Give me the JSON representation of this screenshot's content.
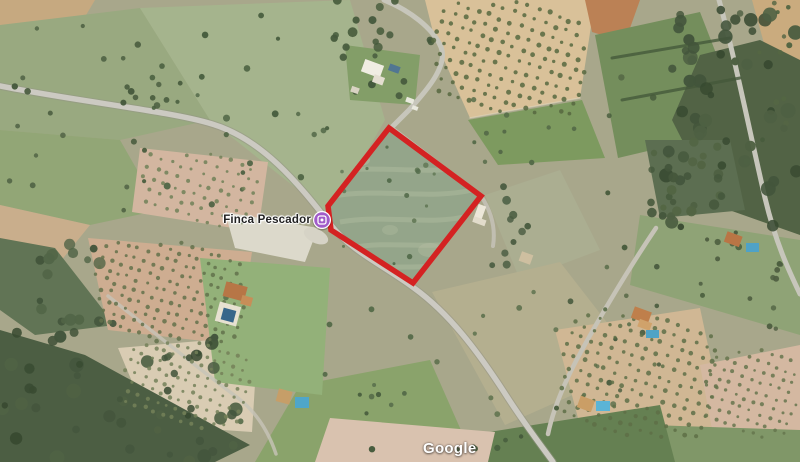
{
  "map": {
    "place": {
      "name": "Finca Pescador",
      "pin_icon": "lodging-pin-icon",
      "pin_color": "#a15cc9",
      "pin_ring_color": "#ffffff"
    },
    "parcel_outline": {
      "color": "#d42222",
      "stroke_width": "5.5",
      "points": "389,128 481,196 413,283 331,230 328,206"
    },
    "attribution": {
      "logo_text": "Google"
    }
  }
}
